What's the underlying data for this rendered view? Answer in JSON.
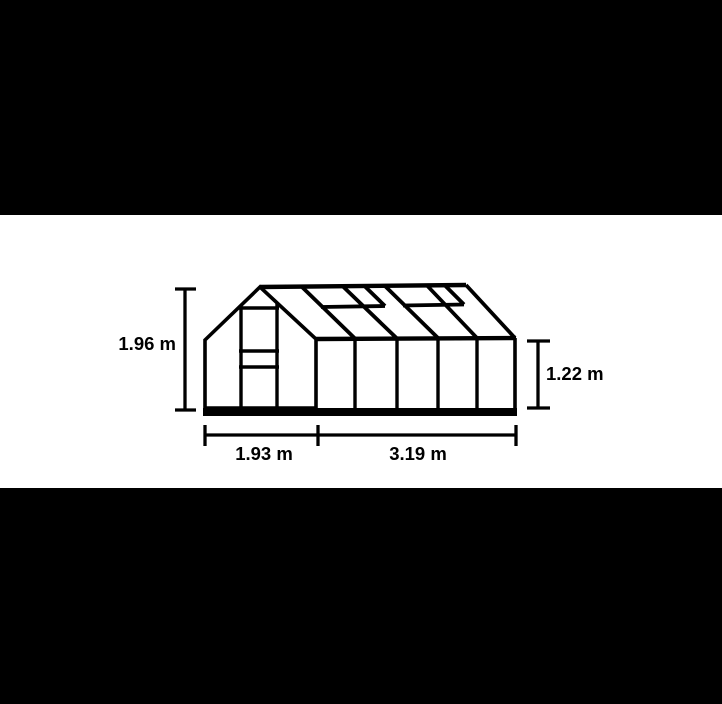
{
  "diagram": {
    "subject": "greenhouse-dimension-diagram",
    "measurements": {
      "total_height": {
        "label": "1.96 m",
        "meters": 1.96,
        "position": "left"
      },
      "wall_height": {
        "label": "1.22 m",
        "meters": 1.22,
        "position": "right"
      },
      "gable_width": {
        "label": "1.93 m",
        "meters": 1.93,
        "position": "bottom-left"
      },
      "side_length": {
        "label": "3.19 m",
        "meters": 3.19,
        "position": "bottom-right"
      },
      "unit": "m"
    },
    "colors": {
      "line": "#000000",
      "drawing_background": "#ffffff",
      "letterbox": "#000000"
    }
  }
}
